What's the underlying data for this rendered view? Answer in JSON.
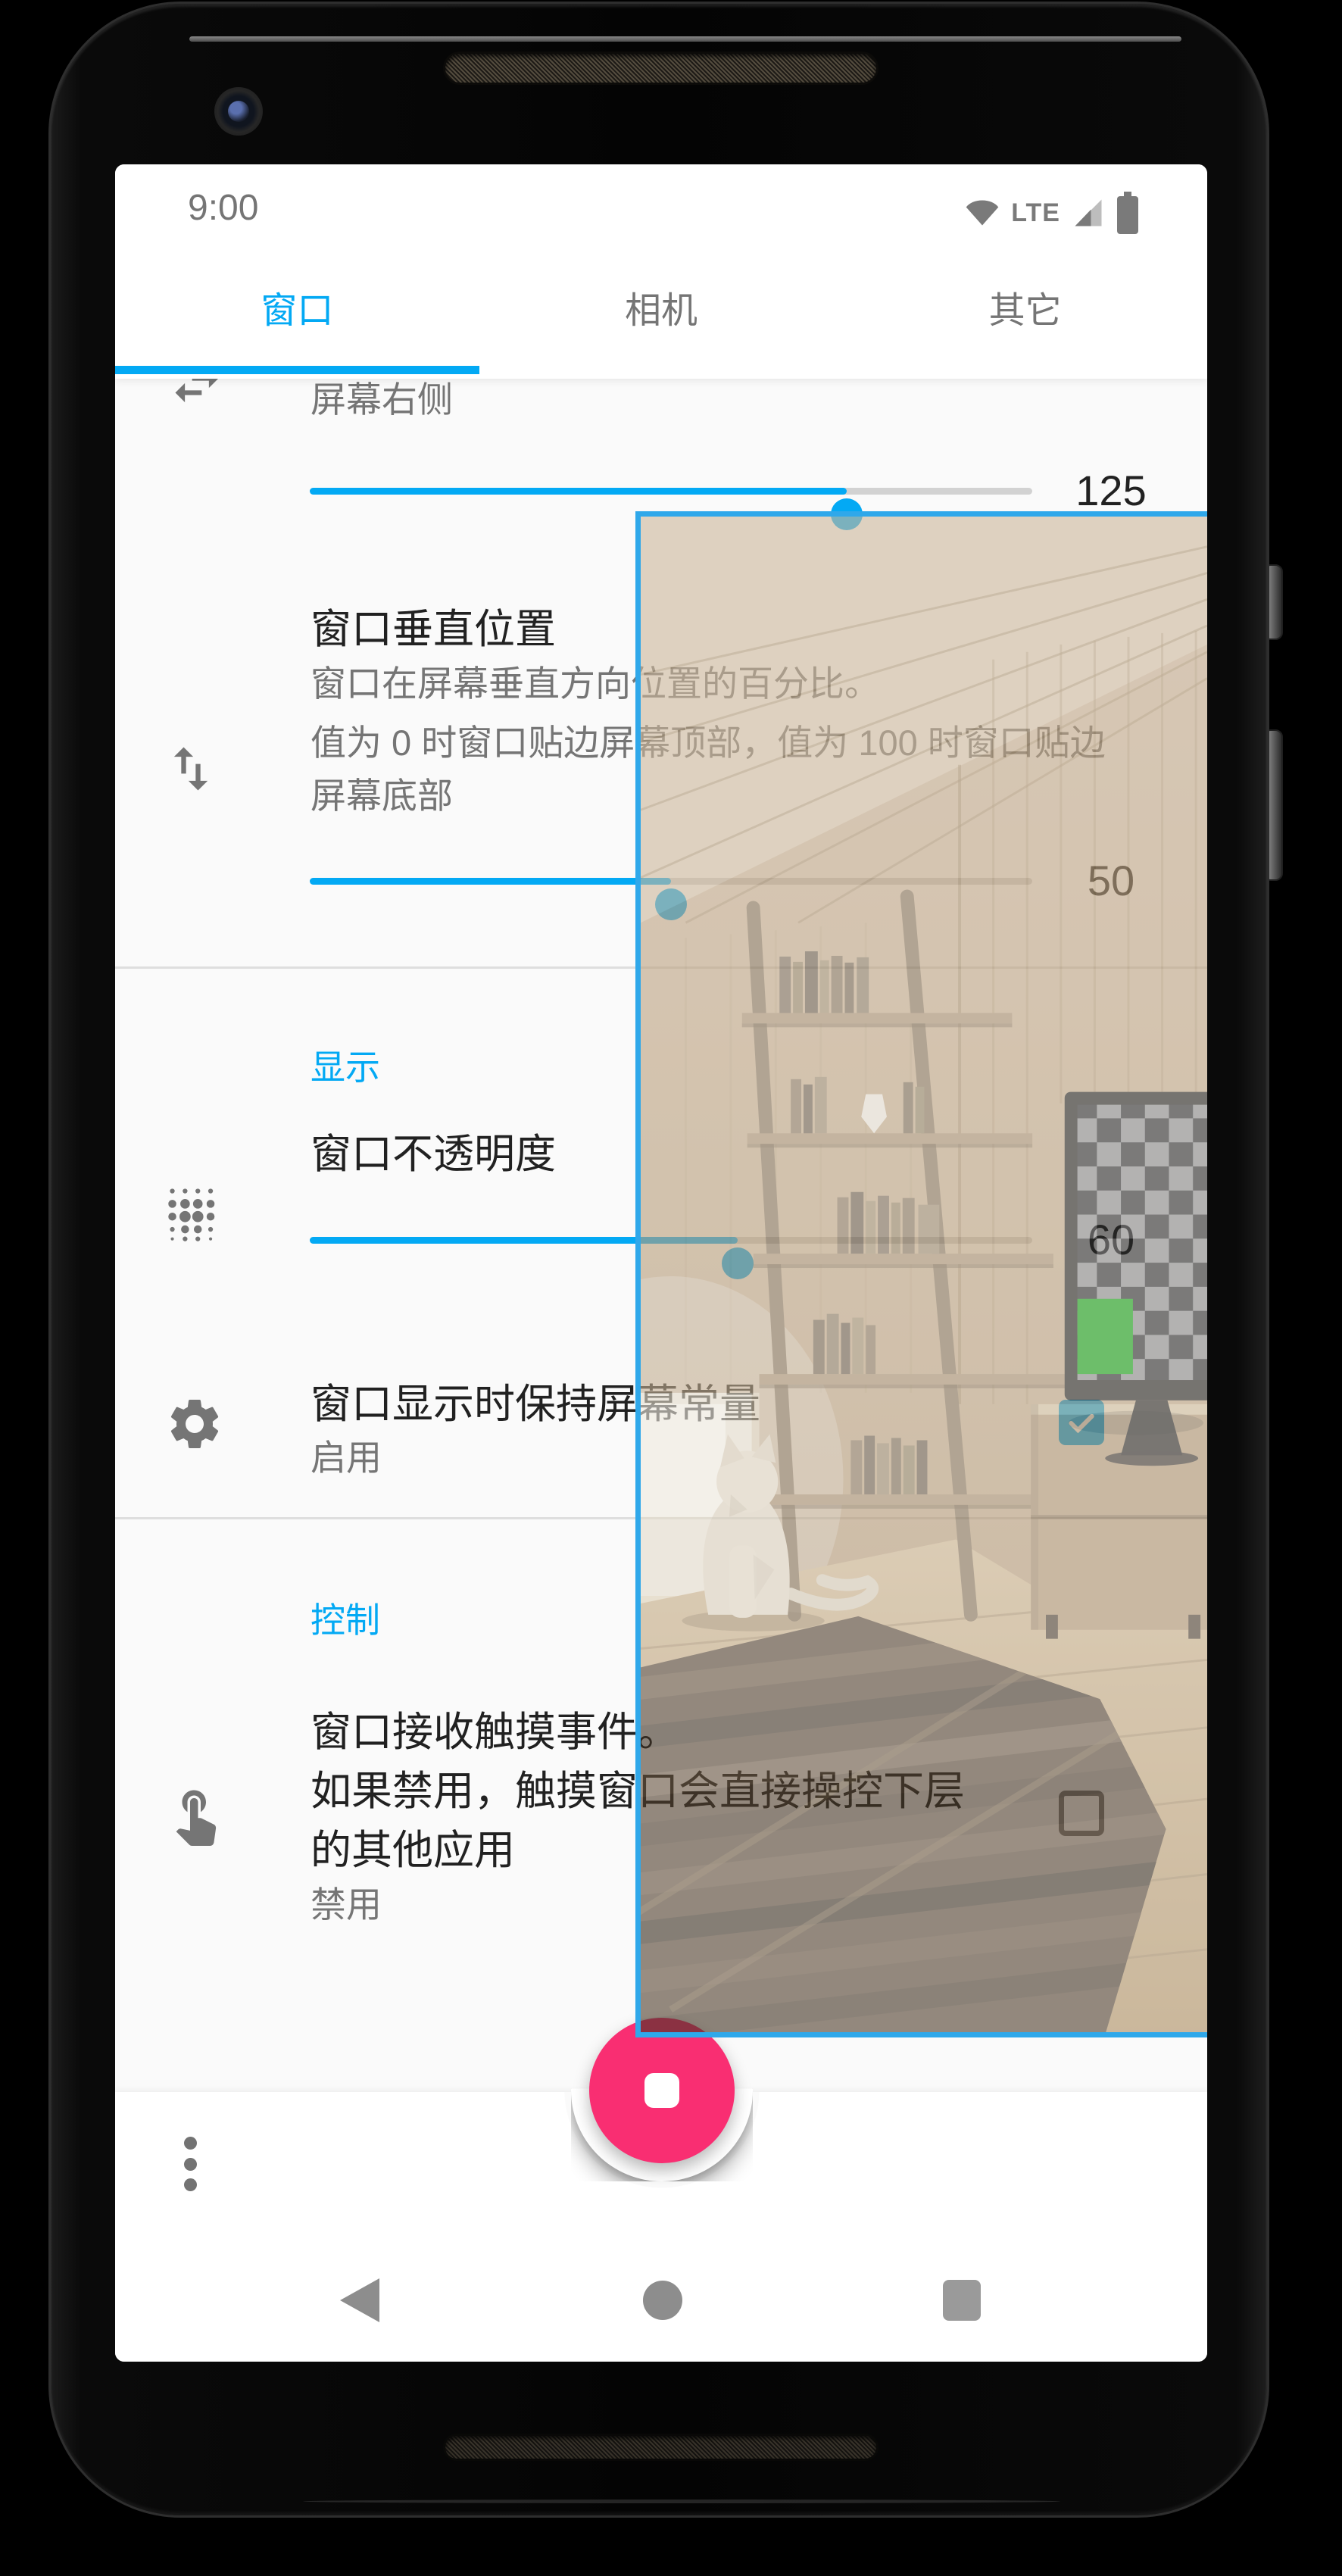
{
  "status_bar": {
    "time": "9:00",
    "network": "LTE"
  },
  "tabs": {
    "items": [
      {
        "label": "窗口",
        "active": true
      },
      {
        "label": "相机",
        "active": false
      },
      {
        "label": "其它",
        "active": false
      }
    ]
  },
  "window_tab": {
    "horizontal_position": {
      "subtitle": "屏幕右侧",
      "value": "125",
      "percent": 74.3
    },
    "vertical_position": {
      "title": "窗口垂直位置",
      "description_line1": "窗口在屏幕垂直方向位置的百分比。",
      "description_line2": "值为 0 时窗口贴边屏幕顶部，值为 100 时窗口贴边",
      "description_line3": "屏幕底部",
      "value": "50",
      "percent": 50
    },
    "display_section": {
      "header": "显示"
    },
    "opacity_row": {
      "title": "窗口不透明度",
      "value": "60",
      "percent": 59.2
    },
    "keep_screen_row": {
      "title": "窗口显示时保持屏幕常量",
      "state": "启用",
      "checked": true
    },
    "control_section": {
      "header": "控制"
    },
    "touch_row": {
      "title_line1": "窗口接收触摸事件。",
      "title_line2": "如果禁用，触摸窗口会直接操控下层",
      "title_line3": "的其他应用",
      "state": "禁用",
      "checked": false
    }
  },
  "fab": {
    "icon": "stop-icon"
  },
  "overlay_window": {
    "content": "camera-preview-room-scene",
    "opacity_percent": 60
  },
  "icons": {
    "row1": "swap-horizontal-icon",
    "row2": "swap-vertical-icon",
    "row3": "opacity-dots-icon",
    "row4": "gear-icon",
    "row5": "touch-icon",
    "status": [
      "wifi-icon",
      "signal-icon",
      "battery-icon"
    ],
    "nav": [
      "back-icon",
      "home-icon",
      "recents-icon"
    ],
    "menu": "overflow-menu-icon"
  },
  "colors": {
    "accent": "#03A9F4",
    "fab_pink": "#F92E72",
    "overlay_border": "#2FA8EA",
    "title_text": "#212121",
    "secondary_text": "#757575",
    "divider": "#dedede",
    "content_bg": "#fafafa",
    "bar_bg": "#ffffff",
    "checker_green": "#0FA00A"
  }
}
